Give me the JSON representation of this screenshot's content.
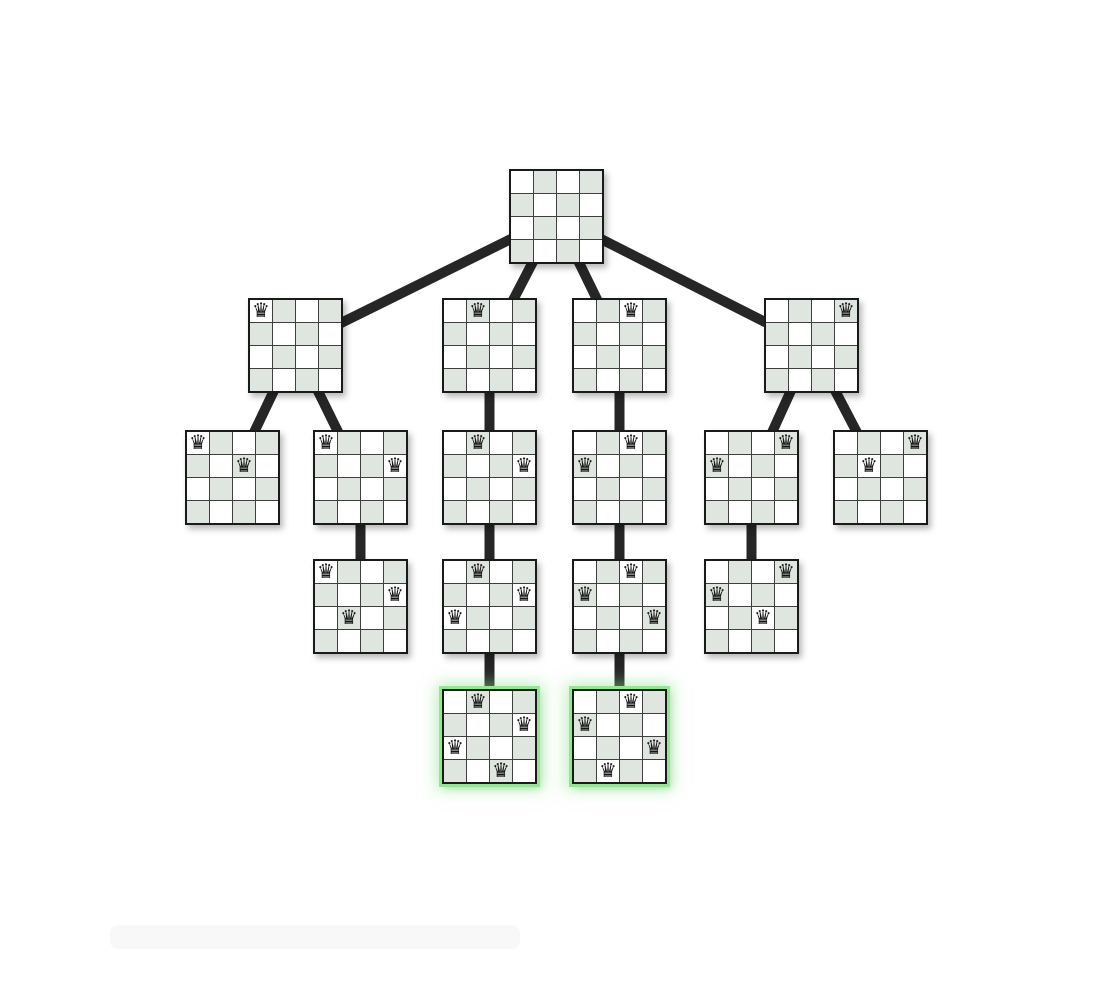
{
  "page": {
    "background": "#ffffff",
    "width": 1118,
    "height": 992
  },
  "colors": {
    "cell_light": "#ffffff",
    "cell_dark": "#dfe5df",
    "grid_line": "#3f3f3f",
    "board_border": "#1a1a1a",
    "edge_line": "#262626",
    "queen": "#141414",
    "solution_ring": "#92e792",
    "solution_glow": "rgba(140,230,140,0.55)"
  },
  "icons": {
    "queen_glyph": "♛"
  },
  "tree": {
    "board_px": 95,
    "grid_size": 4,
    "edge_width_px": 10,
    "nodes": [
      {
        "id": "root",
        "x": 509,
        "y": 169,
        "queens": [],
        "solution": false
      },
      {
        "id": "a1",
        "x": 248,
        "y": 298,
        "queens": [
          [
            0,
            0
          ]
        ],
        "solution": false
      },
      {
        "id": "a2",
        "x": 442,
        "y": 298,
        "queens": [
          [
            0,
            1
          ]
        ],
        "solution": false
      },
      {
        "id": "a3",
        "x": 572,
        "y": 298,
        "queens": [
          [
            0,
            2
          ]
        ],
        "solution": false
      },
      {
        "id": "a4",
        "x": 764,
        "y": 298,
        "queens": [
          [
            0,
            3
          ]
        ],
        "solution": false
      },
      {
        "id": "b1",
        "x": 185,
        "y": 430,
        "queens": [
          [
            0,
            0
          ],
          [
            1,
            2
          ]
        ],
        "solution": false
      },
      {
        "id": "b2",
        "x": 313,
        "y": 430,
        "queens": [
          [
            0,
            0
          ],
          [
            1,
            3
          ]
        ],
        "solution": false
      },
      {
        "id": "b3",
        "x": 442,
        "y": 430,
        "queens": [
          [
            0,
            1
          ],
          [
            1,
            3
          ]
        ],
        "solution": false
      },
      {
        "id": "b4",
        "x": 572,
        "y": 430,
        "queens": [
          [
            0,
            2
          ],
          [
            1,
            0
          ]
        ],
        "solution": false
      },
      {
        "id": "b5",
        "x": 704,
        "y": 430,
        "queens": [
          [
            0,
            3
          ],
          [
            1,
            0
          ]
        ],
        "solution": false
      },
      {
        "id": "b6",
        "x": 833,
        "y": 430,
        "queens": [
          [
            0,
            3
          ],
          [
            1,
            1
          ]
        ],
        "solution": false
      },
      {
        "id": "c1",
        "x": 313,
        "y": 559,
        "queens": [
          [
            0,
            0
          ],
          [
            1,
            3
          ],
          [
            2,
            1
          ]
        ],
        "solution": false
      },
      {
        "id": "c2",
        "x": 442,
        "y": 559,
        "queens": [
          [
            0,
            1
          ],
          [
            1,
            3
          ],
          [
            2,
            0
          ]
        ],
        "solution": false
      },
      {
        "id": "c3",
        "x": 572,
        "y": 559,
        "queens": [
          [
            0,
            2
          ],
          [
            1,
            0
          ],
          [
            2,
            3
          ]
        ],
        "solution": false
      },
      {
        "id": "c4",
        "x": 704,
        "y": 559,
        "queens": [
          [
            0,
            3
          ],
          [
            1,
            0
          ],
          [
            2,
            2
          ]
        ],
        "solution": false
      },
      {
        "id": "d1",
        "x": 442,
        "y": 689,
        "queens": [
          [
            0,
            1
          ],
          [
            1,
            3
          ],
          [
            2,
            0
          ],
          [
            3,
            2
          ]
        ],
        "solution": true
      },
      {
        "id": "d2",
        "x": 572,
        "y": 689,
        "queens": [
          [
            0,
            2
          ],
          [
            1,
            0
          ],
          [
            2,
            3
          ],
          [
            3,
            1
          ]
        ],
        "solution": true
      }
    ],
    "edges": [
      [
        "root",
        "a1"
      ],
      [
        "root",
        "a2"
      ],
      [
        "root",
        "a3"
      ],
      [
        "root",
        "a4"
      ],
      [
        "a1",
        "b1"
      ],
      [
        "a1",
        "b2"
      ],
      [
        "a2",
        "b3"
      ],
      [
        "a3",
        "b4"
      ],
      [
        "a4",
        "b5"
      ],
      [
        "a4",
        "b6"
      ],
      [
        "b2",
        "c1"
      ],
      [
        "b3",
        "c2"
      ],
      [
        "b4",
        "c3"
      ],
      [
        "b5",
        "c4"
      ],
      [
        "c2",
        "d1"
      ],
      [
        "c3",
        "d2"
      ]
    ]
  }
}
